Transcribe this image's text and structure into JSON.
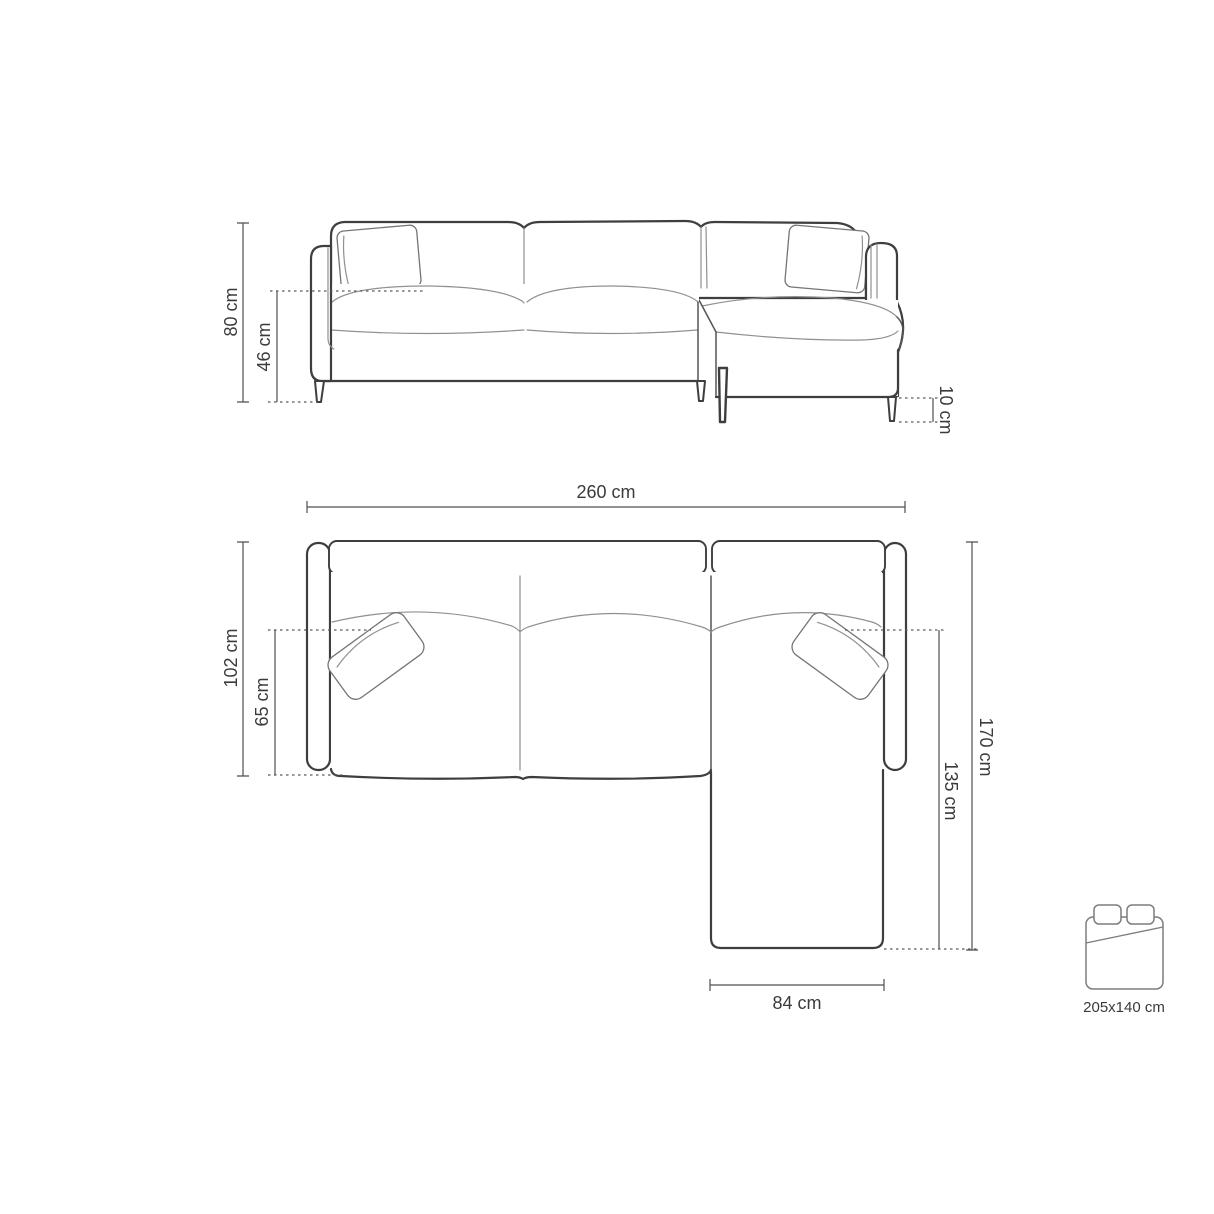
{
  "front": {
    "view_name": "front-elevation",
    "overall_height": "80 cm",
    "seat_height": "46 cm",
    "leg_height": "10 cm"
  },
  "top": {
    "view_name": "top-plan",
    "overall_width": "260 cm",
    "overall_depth": "102 cm",
    "seat_depth": "65 cm",
    "chaise_outer_length": "170 cm",
    "chaise_inner_length": "135 cm",
    "chaise_width": "84 cm"
  },
  "sleeping_area": {
    "icon": "double-bed-top-view-icon",
    "label": "205x140 cm"
  },
  "colors": {
    "outline": "#3e3e3e",
    "seam": "#909090",
    "dimension": "#4f4f4f",
    "text": "#3b3b3b",
    "background": "#ffffff"
  }
}
